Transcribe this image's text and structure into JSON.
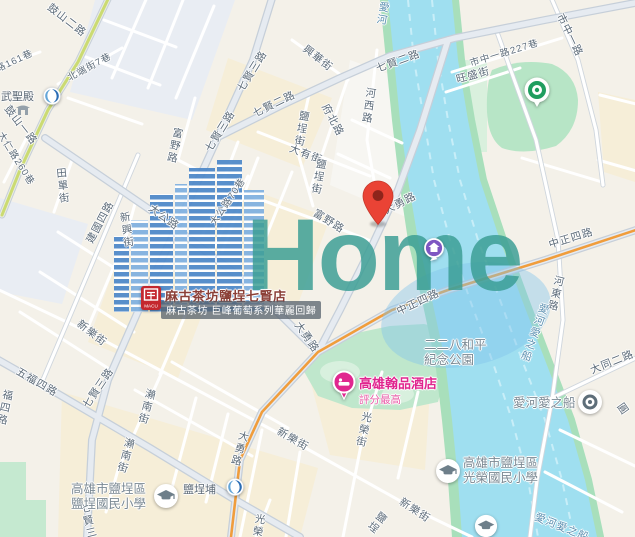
{
  "map": {
    "watermark": {
      "logo_text": "Home"
    },
    "marker": {
      "label": "selected-location",
      "color": "#ea4335"
    },
    "colors": {
      "river": "#9fdff0",
      "river_bank": "#a8dfbb",
      "park": "#bce7cc",
      "route_highlight_orange": "#f09d3c",
      "green_road_stripe": "#cbdb72",
      "brand_building_blue": "#4d88c9",
      "brand_text_teal": "#3a9d94",
      "hotel_pink": "#e0268f",
      "metro_blue": "#2a6db5",
      "park_icon_green": "#1f9e5f",
      "shop_red": "#c4272e"
    },
    "icons": {
      "marker": "red-pin",
      "metro": "kmrt-swirl",
      "school": "graduation-cap",
      "boat_dock": "circle-dot",
      "park": "green-ring-dot",
      "hotel": "pink-pin",
      "shop": "macu-logo",
      "lodging": "purple-circle-pin",
      "temple": "temple-glyph"
    },
    "pois": {
      "shop": {
        "name": "麻古茶坊鹽埕七賢店",
        "banner": "麻古茶坊 巨峰葡萄系列華麗回歸",
        "icon_char": "麻",
        "icon_sub": "MACU"
      },
      "hotel": {
        "name": "高雄翰品酒店",
        "subtitle": "評分最高"
      },
      "school1": {
        "line1": "高雄市鹽埕區",
        "line2": "鹽埕國民小學"
      },
      "school2": {
        "line1": "高雄市鹽埕區",
        "line2": "光榮國民小學"
      },
      "boat": {
        "name": "愛河愛之船"
      },
      "temple": {
        "name": "武聖殿"
      },
      "station": {
        "name": "鹽埕埔"
      },
      "park_label": {
        "line1": "二二八和平",
        "line2": "紀念公園"
      }
    },
    "street_labels": [
      {
        "t": "鼓山二路",
        "x": 67,
        "y": 20,
        "r": 38
      },
      {
        "t": "路161巷",
        "x": 14,
        "y": 60,
        "r": -25,
        "s": 9.5
      },
      {
        "t": "北端街7巷",
        "x": 89,
        "y": 66,
        "r": -28,
        "s": 9.5
      },
      {
        "t": "鼓山一路",
        "x": 21,
        "y": 125,
        "r": 52
      },
      {
        "t": "大仁路260巷",
        "x": 17,
        "y": 158,
        "r": 58,
        "s": 9.5
      },
      {
        "t": "田單街",
        "x": 63,
        "y": 186,
        "v": 1,
        "r": -6
      },
      {
        "t": "建國四路",
        "x": 100,
        "y": 222,
        "r": -62
      },
      {
        "t": "新興街",
        "x": 127,
        "y": 230,
        "v": 1,
        "r": -8
      },
      {
        "t": "七賢三路",
        "x": 252,
        "y": 71,
        "r": -58
      },
      {
        "t": "七賢三路",
        "x": 220,
        "y": 131,
        "r": -58
      },
      {
        "t": "七賢二路",
        "x": 274,
        "y": 104,
        "r": -26
      },
      {
        "t": "七賢二路",
        "x": 398,
        "y": 61,
        "r": -20
      },
      {
        "t": "興華街",
        "x": 318,
        "y": 58,
        "r": 38
      },
      {
        "t": "愛河",
        "x": 383,
        "y": 14,
        "v": 1,
        "r": 10,
        "c": "water"
      },
      {
        "t": "河西路",
        "x": 369,
        "y": 106,
        "v": 1,
        "r": 8
      },
      {
        "t": "府北路",
        "x": 333,
        "y": 120,
        "r": 62
      },
      {
        "t": "大有街",
        "x": 306,
        "y": 154,
        "r": 21
      },
      {
        "t": "鹽埕街",
        "x": 302,
        "y": 129,
        "v": 1,
        "r": 10
      },
      {
        "t": "鹽埕街",
        "x": 319,
        "y": 177,
        "v": 1,
        "r": 10
      },
      {
        "t": "市中一路227巷",
        "x": 504,
        "y": 52,
        "r": -17,
        "s": 9.5
      },
      {
        "t": "旺盛街",
        "x": 473,
        "y": 75,
        "r": -15
      },
      {
        "t": "市中一路",
        "x": 570,
        "y": 35,
        "r": 64
      },
      {
        "t": "大公路",
        "x": 164,
        "y": 217,
        "r": 36
      },
      {
        "t": "大公路70巷",
        "x": 227,
        "y": 201,
        "r": -56,
        "s": 9.5
      },
      {
        "t": "富野路",
        "x": 175,
        "y": 146,
        "v": 1,
        "r": 12
      },
      {
        "t": "富野路",
        "x": 329,
        "y": 221,
        "r": 32
      },
      {
        "t": "大勇路",
        "x": 400,
        "y": 203,
        "r": -27
      },
      {
        "t": "大勇路",
        "x": 307,
        "y": 337,
        "r": 55
      },
      {
        "t": "大勇路",
        "x": 240,
        "y": 449,
        "v": 1,
        "r": 16
      },
      {
        "t": "中正四路",
        "x": 418,
        "y": 302,
        "r": -25
      },
      {
        "t": "中正四路",
        "x": 571,
        "y": 238,
        "r": -17
      },
      {
        "t": "河東路",
        "x": 556,
        "y": 294,
        "v": 1,
        "r": 13
      },
      {
        "t": "愛河愛之船",
        "x": 535,
        "y": 333,
        "v": 1,
        "r": 20,
        "c": "water"
      },
      {
        "t": "五福四路",
        "x": 37,
        "y": 382,
        "r": 30
      },
      {
        "t": "福四路",
        "x": 5,
        "y": 408,
        "v": 1,
        "r": 12
      },
      {
        "t": "七賢三路",
        "x": 98,
        "y": 388,
        "r": -56
      },
      {
        "t": "七賢三路",
        "x": 90,
        "y": 527,
        "v": 1,
        "r": -14
      },
      {
        "t": "新樂街",
        "x": 92,
        "y": 333,
        "r": 38
      },
      {
        "t": "新樂街",
        "x": 293,
        "y": 439,
        "r": 30
      },
      {
        "t": "新樂街",
        "x": 415,
        "y": 510,
        "r": 33
      },
      {
        "t": "瀨南街",
        "x": 147,
        "y": 407,
        "v": 1,
        "r": 15
      },
      {
        "t": "瀨南街",
        "x": 126,
        "y": 456,
        "v": 1,
        "r": 15
      },
      {
        "t": "光榮街",
        "x": 364,
        "y": 430,
        "v": 1,
        "r": 12
      },
      {
        "t": "光榮街",
        "x": 258,
        "y": 532,
        "v": 1,
        "r": 10
      },
      {
        "t": "鹽埕",
        "x": 377,
        "y": 523,
        "v": 1,
        "r": 38
      },
      {
        "t": "愛河愛之船",
        "x": 562,
        "y": 527,
        "r": 22,
        "c": "water"
      },
      {
        "t": "大同二路",
        "x": 612,
        "y": 362,
        "r": -22
      },
      {
        "t": "圓",
        "x": 623,
        "y": 409,
        "r": 55
      }
    ]
  }
}
